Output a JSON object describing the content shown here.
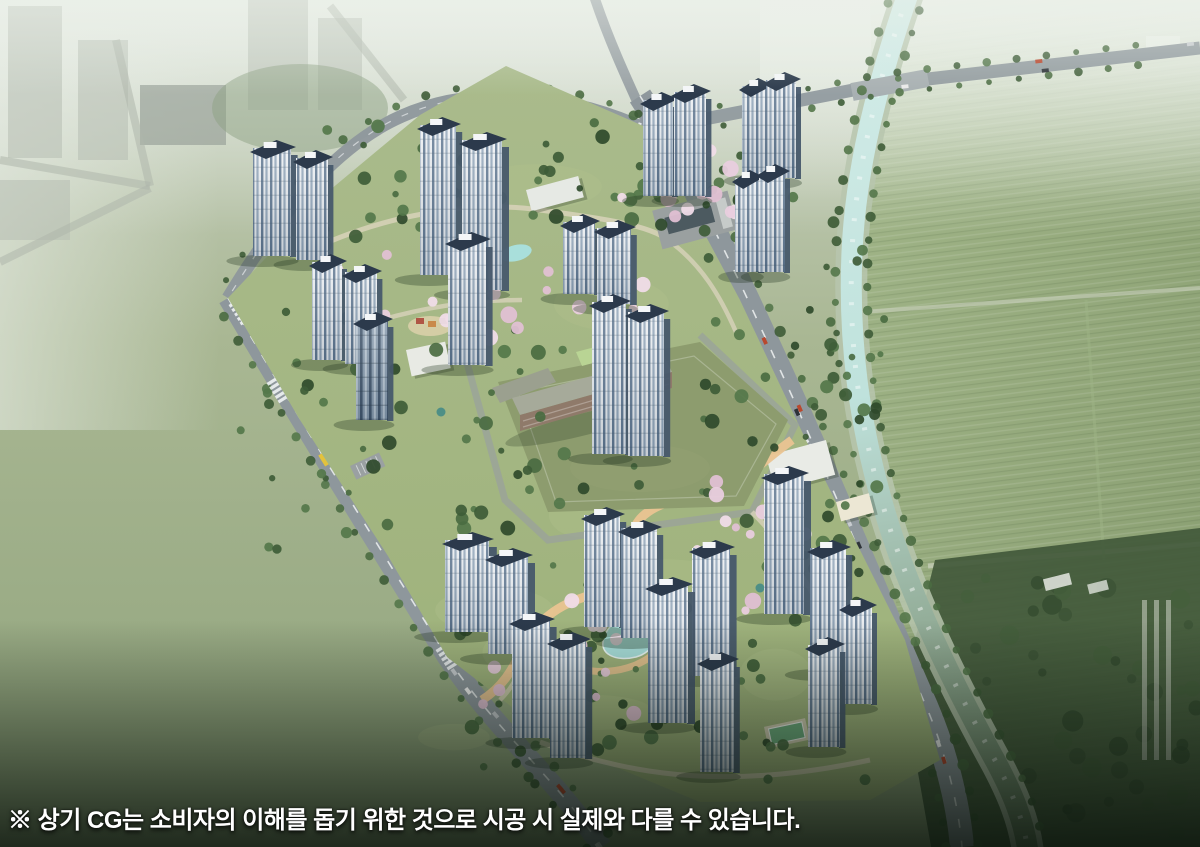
{
  "page": {
    "caption": "※ 상기 CG는 소비자의 이해를 돕기 위한 것으로 시공 시 실제와 다를 수 있습니다."
  },
  "scene": {
    "type": "aerial-architectural-cg-render",
    "subject": "apartment-complex-birdseye-view",
    "colors": {
      "haze_top": "#ccd4c8",
      "ground_mid": "#a9b793",
      "ground_deep": "#8fa37b",
      "farmland_light": "#a3b78a",
      "farmland_dark": "#879c6f",
      "woods": "#42593b",
      "river_light": "#cde9e4",
      "river_dark": "#68805f",
      "riverbank": "#b7c6ae",
      "road": "#8e979c",
      "road_marking": "#f5f7f8",
      "site_lawn": "#a4b886",
      "path_tan": "#d8d2ba",
      "promenade": "#eac491",
      "pond": "#a9dfdb",
      "tree": "#4a6b41",
      "tree_dark": "#2f4a2b",
      "blossom": "#e9cede",
      "tower_side": "#47596c",
      "roof_navy": "#2c3a4c",
      "rooftop_white": "#f4f6f8",
      "school_field": "#8d9c6e",
      "school_roof": "#a6aa9a",
      "school_brick": "#8f7a6a",
      "school_green_roof": "#b9d494",
      "city_dark": "#38443c",
      "city_block_top": "#6f7c71",
      "city_block_front": "#4d5850",
      "caption_text": "#ffffff",
      "bus_yellow": "#e3c23c",
      "court_green": "#6fae7f",
      "shadow": "#23351f"
    }
  }
}
